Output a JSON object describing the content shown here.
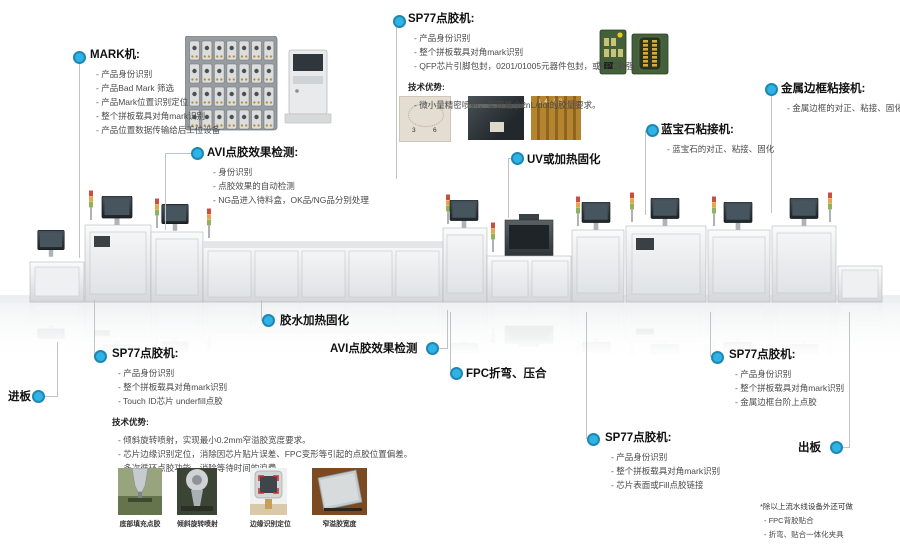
{
  "colors": {
    "accent": "#2fb3e4",
    "accent_ring": "#1d87b4",
    "connector": "#bdc3c7",
    "heading": "#111111",
    "body_text": "#4a4a4a"
  },
  "callouts": {
    "mark": {
      "title": "MARK机:",
      "items": [
        "产品身份识别",
        "产品Bad Mark 筛选",
        "产品Mark位置识别定位",
        "整个拼板载具对角mark识别",
        "产品位置数据传输给后工位设备"
      ]
    },
    "sp77_top": {
      "title": "SP77点胶机:",
      "items": [
        "产品身份识别",
        "整个拼板载具对角mark识别",
        "QFP芯片引脚包封，0201/01005元器件包封，或FPC补强"
      ],
      "tech_title": "技术优势:",
      "tech_items": [
        "微小量精密喷射，实现最小2nL/dot的胶量要求。"
      ]
    },
    "avi_top": {
      "title": "AVI点胶效果检测:",
      "items": [
        "身份识别",
        "点胶效果的自动检测",
        "NG品进入待料盒，OK品/NG品分别处理"
      ]
    },
    "uv": {
      "title": "UV或加热固化"
    },
    "sapphire": {
      "title": "蓝宝石粘接机:",
      "items": [
        "蓝宝石的对正、粘接、固化"
      ]
    },
    "metal_frame": {
      "title": "金属边框粘接机:",
      "items": [
        "金属边框的对正、粘接、固化"
      ]
    },
    "glue_cure": {
      "title": "胶水加热固化"
    },
    "avi_bottom": {
      "title": "AVI点胶效果检测"
    },
    "fpc_bend": {
      "title": "FPC折弯、压合"
    },
    "board_in": {
      "title": "进板"
    },
    "board_out": {
      "title": "出板"
    },
    "sp77_left": {
      "title": "SP77点胶机:",
      "items": [
        "产品身份识别",
        "整个拼板载具对角mark识别",
        "Touch ID芯片 underfill点胶"
      ],
      "tech_title": "技术优势:",
      "tech_items": [
        "倾斜旋转喷射，实现最小0.2mm窄溢胶宽度要求。",
        "芯片边缘识别定位，消除因芯片贴片误差、FPC变形等引起的点胶位置偏差。",
        "多次循环点胶功能，消除等待时间的浪费。"
      ]
    },
    "sp77_mid": {
      "title": "SP77点胶机:",
      "items": [
        "产品身份识别",
        "整个拼板载具对角mark识别",
        "芯片表面或Fill点胶链接"
      ]
    },
    "sp77_right": {
      "title": "SP77点胶机:",
      "items": [
        "产品身份识别",
        "整个拼板载具对角mark识别",
        "金属边框台阶上点胶"
      ]
    }
  },
  "photos": {
    "sp77_photo1_marks": [
      "3",
      "6"
    ],
    "sp77_photo3_label": "L4 L2"
  },
  "thumbnails": {
    "captions": [
      "底部填充点胶",
      "倾斜旋转喷射",
      "边缘识别定位",
      "窄溢胶宽度"
    ]
  },
  "footnote": {
    "title": "*除以上流水线设备外还可做",
    "items": [
      "FPC背胶贴合",
      "折弯、贴合一体化夹具"
    ]
  }
}
